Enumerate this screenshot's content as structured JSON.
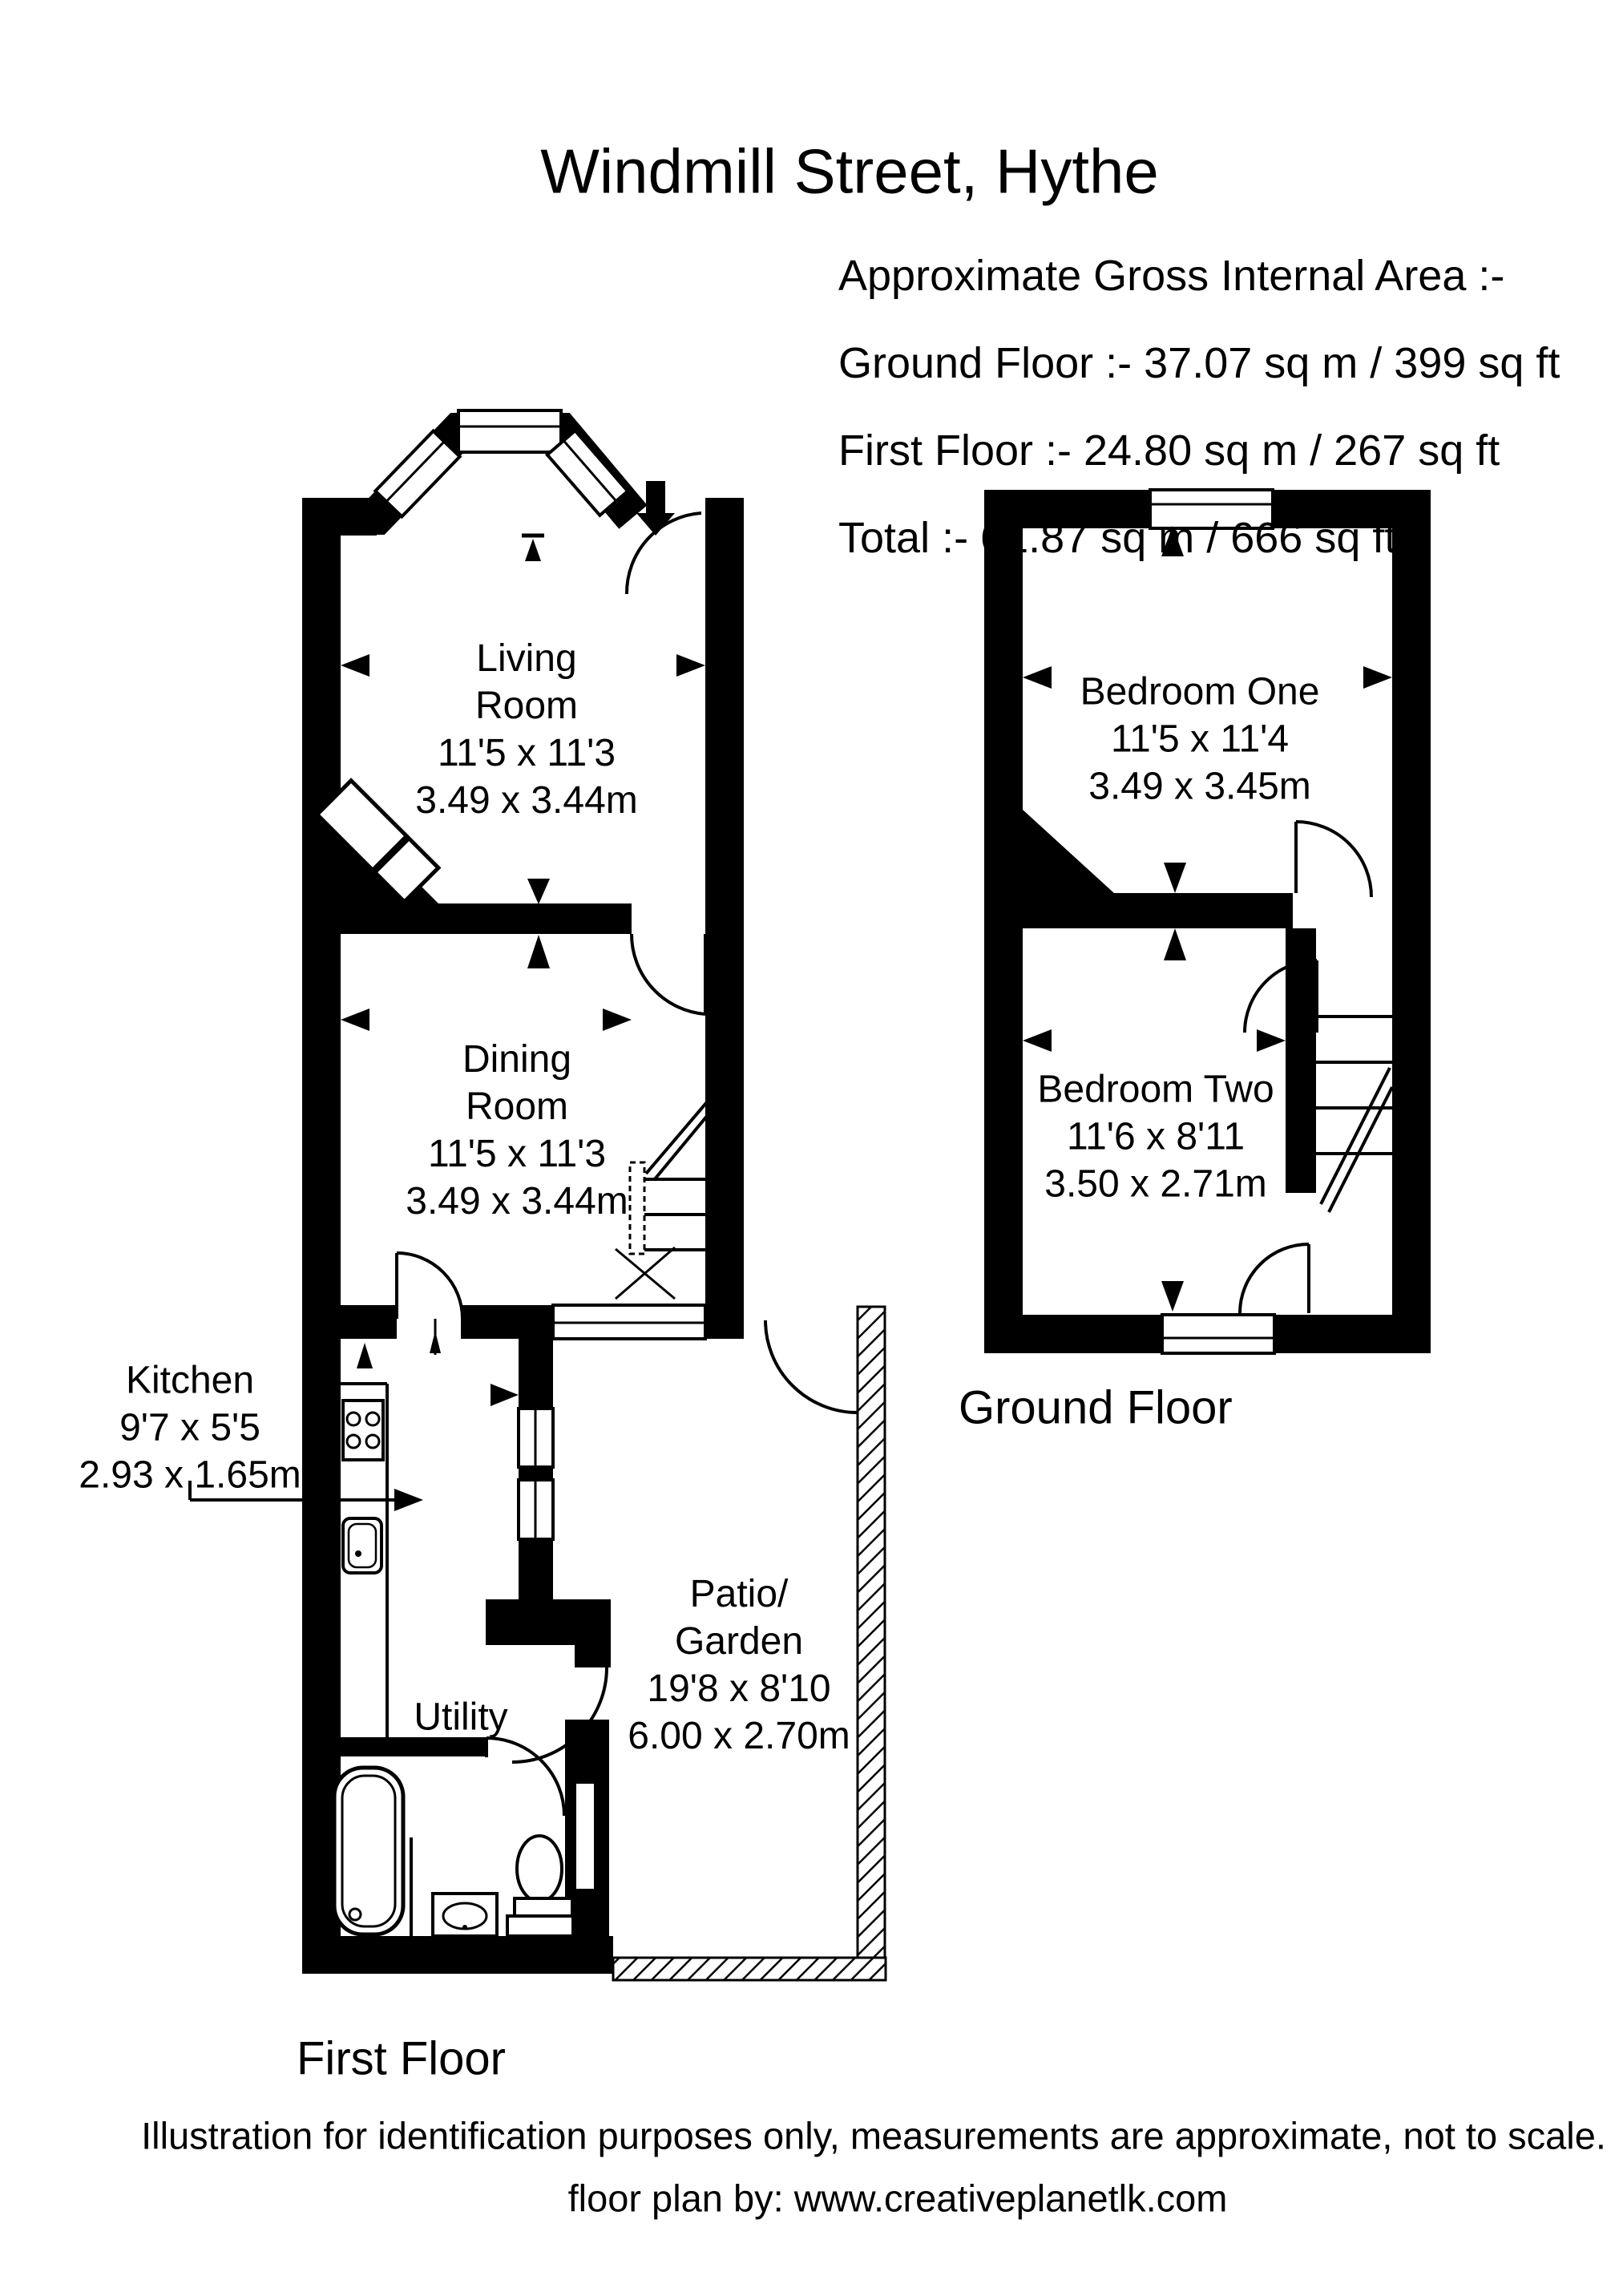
{
  "title": "Windmill Street, Hythe",
  "area_summary": {
    "heading": "Approximate Gross Internal Area :-",
    "ground_floor": "Ground Floor :- 37.07 sq m / 399 sq ft",
    "first_floor": "First Floor :- 24.80 sq m / 267 sq ft",
    "total": "Total :- 61.87 sq m / 666 sq ft"
  },
  "floor_labels": {
    "left_plan": "First Floor",
    "right_plan": "Ground Floor"
  },
  "rooms": {
    "living_room": {
      "line1": "Living",
      "line2": "Room",
      "imperial": "11'5 x 11'3",
      "metric": "3.49 x 3.44m"
    },
    "dining_room": {
      "line1": "Dining",
      "line2": "Room",
      "imperial": "11'5 x 11'3",
      "metric": "3.49 x 3.44m"
    },
    "kitchen": {
      "name": "Kitchen",
      "imperial": "9'7 x 5'5",
      "metric": "2.93 x 1.65m"
    },
    "utility": {
      "name": "Utility"
    },
    "patio_garden": {
      "line1": "Patio/",
      "line2": "Garden",
      "imperial": "19'8 x 8'10",
      "metric": "6.00 x 2.70m"
    },
    "bedroom_one": {
      "name": "Bedroom One",
      "imperial": "11'5 x 11'4",
      "metric": "3.49 x 3.45m"
    },
    "bedroom_two": {
      "name": "Bedroom Two",
      "imperial": "11'6 x 8'11",
      "metric": "3.50 x 2.71m"
    }
  },
  "footer": {
    "disclaimer": "Illustration for identification purposes only, measurements are approximate, not to scale.",
    "credit": "floor plan by: www.creativeplanetlk.com"
  },
  "colors": {
    "wall": "#000000",
    "background": "#ffffff"
  }
}
